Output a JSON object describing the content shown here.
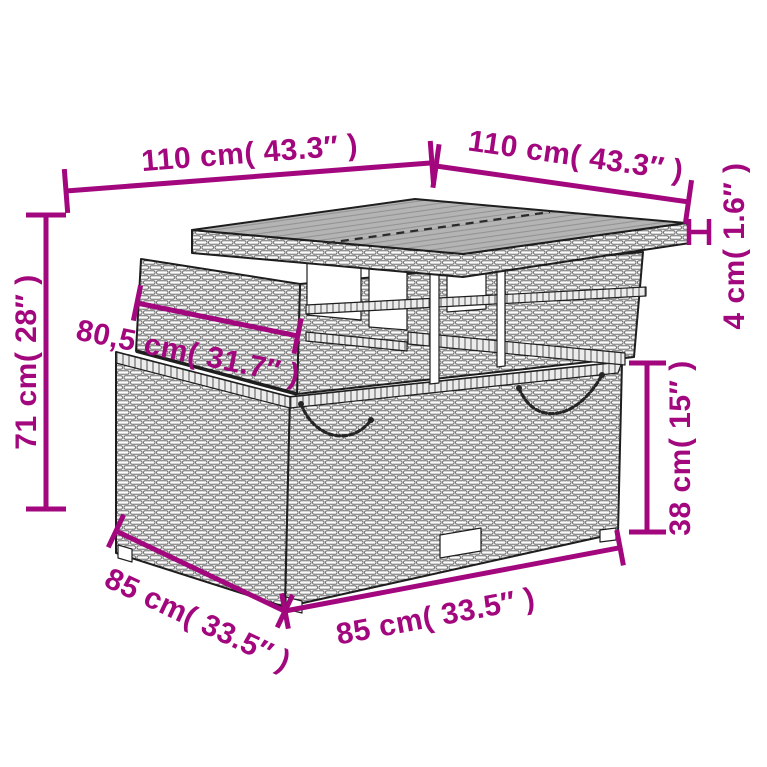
{
  "accent_color": "#A2077E",
  "line_color": "#1e1e1e",
  "subject": "Poly rattan lift-top garden table — dimension line drawing",
  "measurements": {
    "top_width_left": "110 cm( 43.3″ )",
    "top_width_right": "110 cm( 43.3″ )",
    "total_height": "71 cm( 28″ )",
    "frame_width": "80,5 cm( 31.7″ )",
    "tabletop_thickness": "4 cm( 1.6″ )",
    "base_height": "38 cm( 15″ )",
    "base_depth": "85 cm( 33.5″ )",
    "base_width": "85 cm( 33.5″ )"
  }
}
